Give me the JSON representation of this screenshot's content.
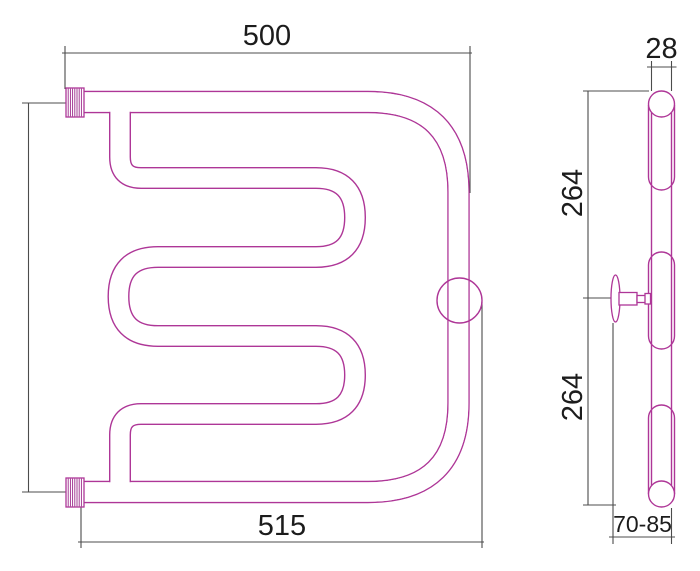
{
  "front_view": {
    "top_width_label": "500",
    "bottom_width_label": "515"
  },
  "side_view": {
    "diameter_label": "28",
    "upper_length_label": "264",
    "lower_length_label": "264",
    "wall_distance_label": "70-85"
  },
  "colors": {
    "pipe": "#ae3697",
    "hatch": "#9c2b8a",
    "dimension": "#4c4c4c",
    "text": "#1c1c1c",
    "background": "#ffffff"
  }
}
